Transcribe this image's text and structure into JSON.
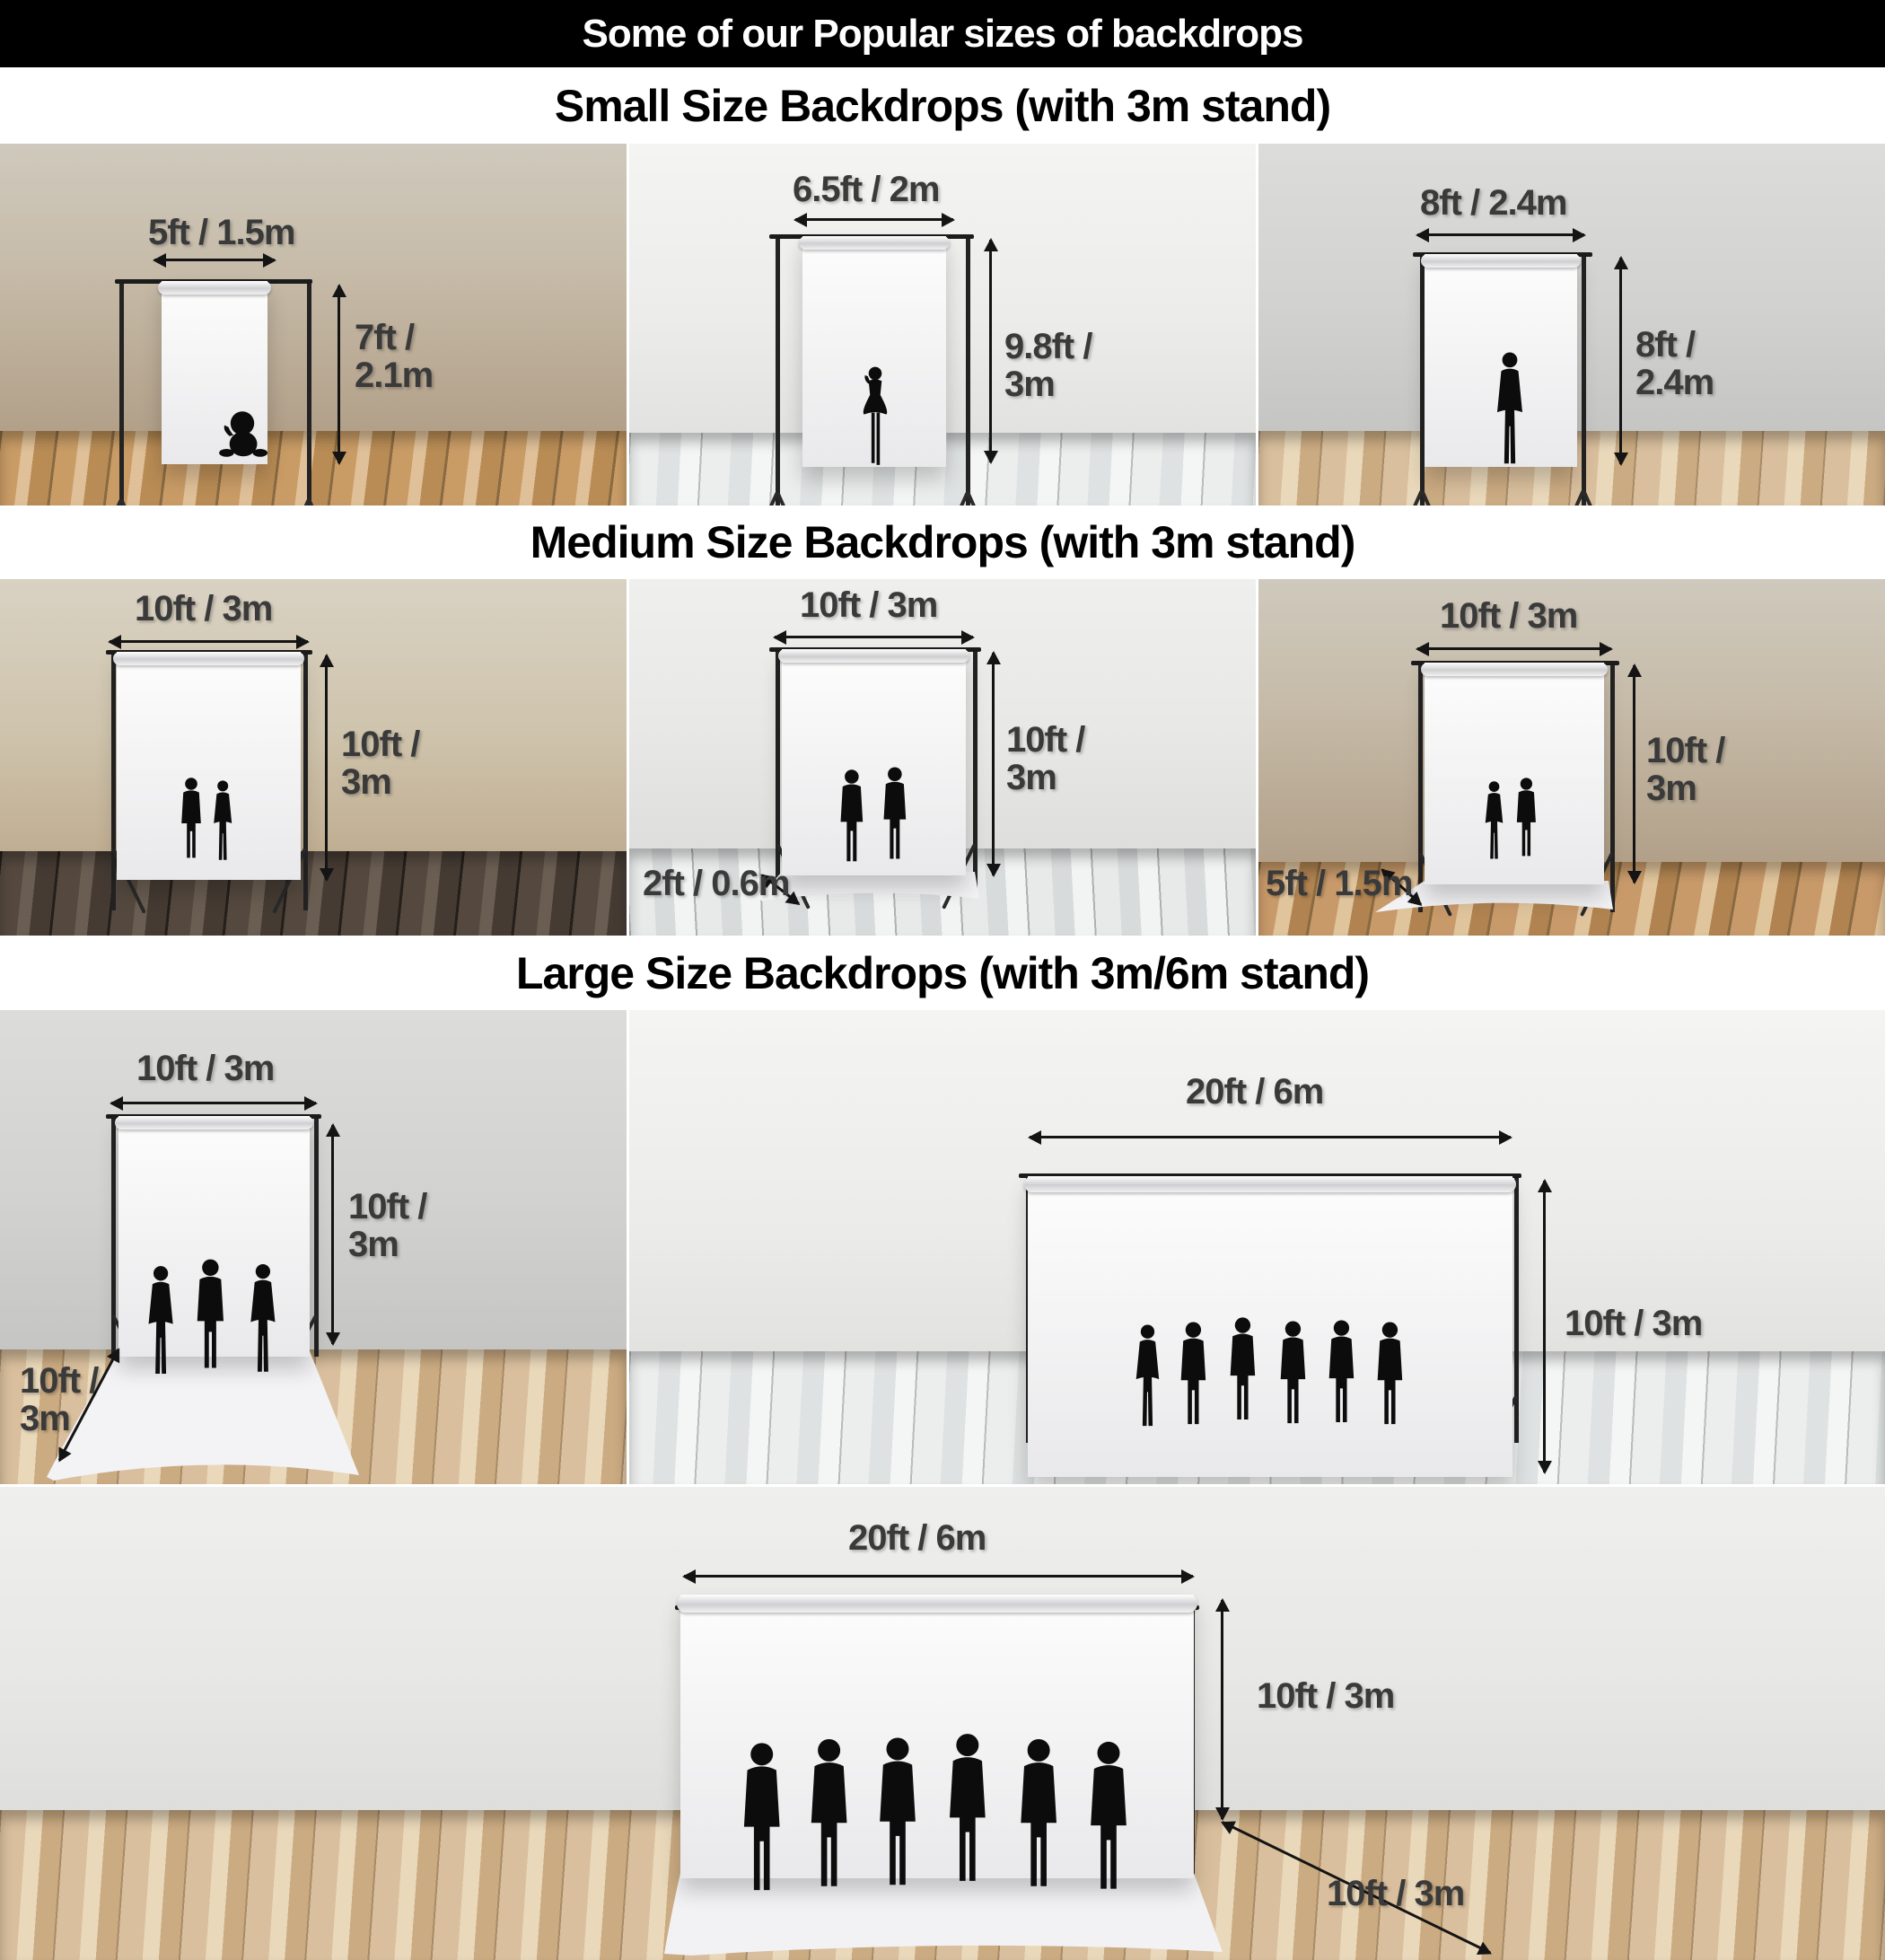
{
  "header": {
    "title": "Some of our Popular sizes of backdrops",
    "bg_color": "#000000",
    "text_color": "#ffffff"
  },
  "sections": [
    {
      "title": "Small Size Backdrops (with 3m stand)"
    },
    {
      "title": "Medium Size Backdrops (with 3m stand)"
    },
    {
      "title": "Large Size Backdrops (with 3m/6m stand)"
    }
  ],
  "colors": {
    "dimension_text": "#3a3a3a",
    "arrow": "#141414",
    "backdrop_white": "#f7f7f8",
    "stand": "#232323"
  },
  "panels": [
    {
      "id": "small-1",
      "width_label": "5ft / 1.5m",
      "height_lines": [
        "7ft /",
        "2.1m"
      ],
      "figure": "baby-silhouette"
    },
    {
      "id": "small-2",
      "width_label": "6.5ft / 2m",
      "height_lines": [
        "9.8ft /",
        "3m"
      ],
      "figure": "girl-silhouette"
    },
    {
      "id": "small-3",
      "width_label": "8ft / 2.4m",
      "height_lines": [
        "8ft /",
        "2.4m"
      ],
      "figure": "posing-woman-silhouette"
    },
    {
      "id": "medium-1",
      "width_label": "10ft / 3m",
      "height_lines": [
        "10ft /",
        "3m"
      ],
      "figure": "couple-silhouette"
    },
    {
      "id": "medium-2",
      "width_label": "10ft / 3m",
      "height_lines": [
        "10ft /",
        "3m"
      ],
      "sweep_lines": [
        "2ft / 0.6m"
      ],
      "figure": "two-men-silhouette"
    },
    {
      "id": "medium-3",
      "width_label": "10ft / 3m",
      "height_lines": [
        "10ft /",
        "3m"
      ],
      "sweep_lines": [
        "5ft / 1.5m"
      ],
      "figure": "couple-silhouette"
    },
    {
      "id": "large-1",
      "width_label": "10ft / 3m",
      "height_lines": [
        "10ft /",
        "3m"
      ],
      "sweep_lines": [
        "10ft /",
        "3m"
      ],
      "figure": "three-business-people-silhouette"
    },
    {
      "id": "large-2",
      "width_label": "20ft / 6m",
      "height_lines": [
        "10ft / 3m"
      ],
      "figure": "six-people-silhouette"
    },
    {
      "id": "large-3",
      "width_label": "20ft / 6m",
      "height_lines": [
        "10ft / 3m"
      ],
      "sweep_lines": [
        "10ft / 3m"
      ],
      "figure": "six-men-silhouette"
    }
  ]
}
